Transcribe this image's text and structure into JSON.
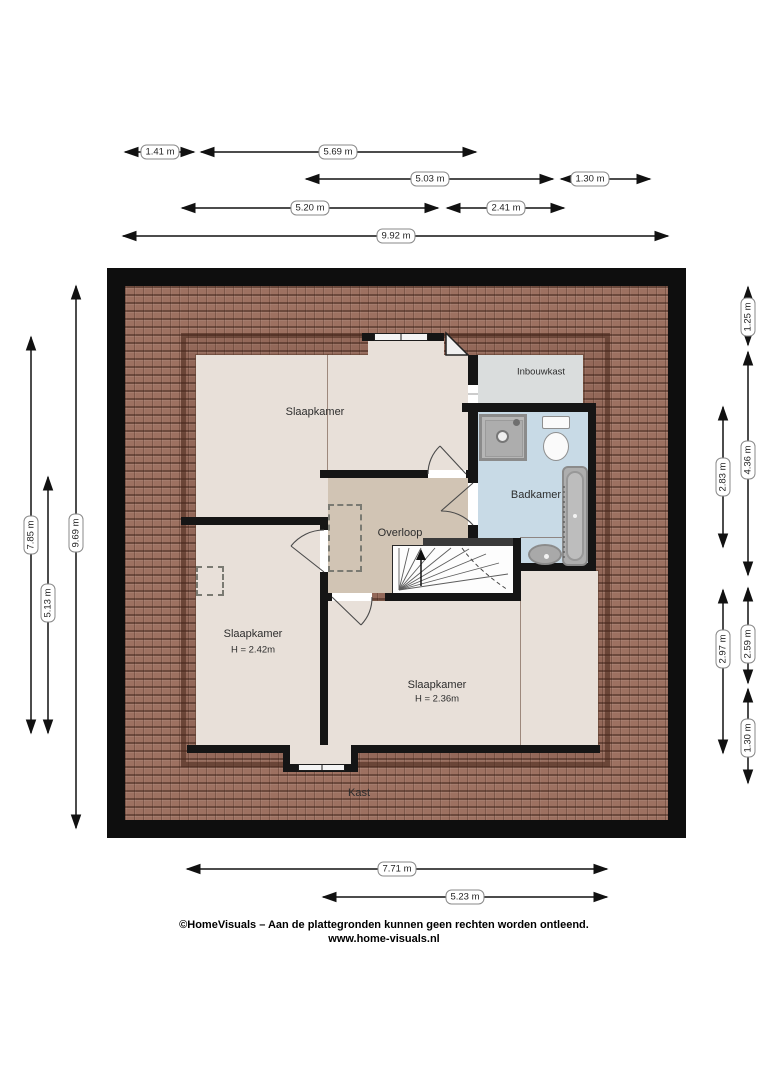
{
  "plan": {
    "type": "floor-plan",
    "floor": "verdieping (upper floor)"
  },
  "rooms": {
    "slaapkamer1": {
      "label": "Slaapkamer"
    },
    "inbouwkast": {
      "label": "Inbouwkast"
    },
    "badkamer": {
      "label": "Badkamer"
    },
    "overloop": {
      "label": "Overloop"
    },
    "slaapkamer2": {
      "label": "Slaapkamer",
      "height": "H = 2.42m"
    },
    "slaapkamer3": {
      "label": "Slaapkamer",
      "height": "H = 2.36m"
    },
    "kast": {
      "label": "Kast"
    }
  },
  "dims": {
    "top": [
      "1.41 m",
      "5.69 m",
      "5.03 m",
      "1.30 m",
      "5.20 m",
      "2.41 m",
      "9.92 m"
    ],
    "left": [
      "7.85 m",
      "5.13 m",
      "9.69 m"
    ],
    "right": [
      "2.83 m",
      "2.97 m",
      "1.25 m",
      "4.36 m",
      "2.59 m",
      "1.30 m"
    ],
    "bottom": [
      "7.71 m",
      "5.23 m"
    ]
  },
  "footer": {
    "line1": "©HomeVisuals – Aan de plattegronden kunnen geen rechten worden ontleend.",
    "line2": "www.home-visuals.nl"
  },
  "colors": {
    "wall": "#151515",
    "roof": "#9d7161",
    "bedroom_floor": "#e8e0d9",
    "landing_floor": "#d1c4b4",
    "bathroom_floor": "#c8dae6",
    "closet_floor": "#dadddd"
  },
  "icons": [
    "shower-icon",
    "toilet-icon",
    "bathtub-icon",
    "sink-icon",
    "stairs-up-arrow-icon",
    "window-icon"
  ]
}
